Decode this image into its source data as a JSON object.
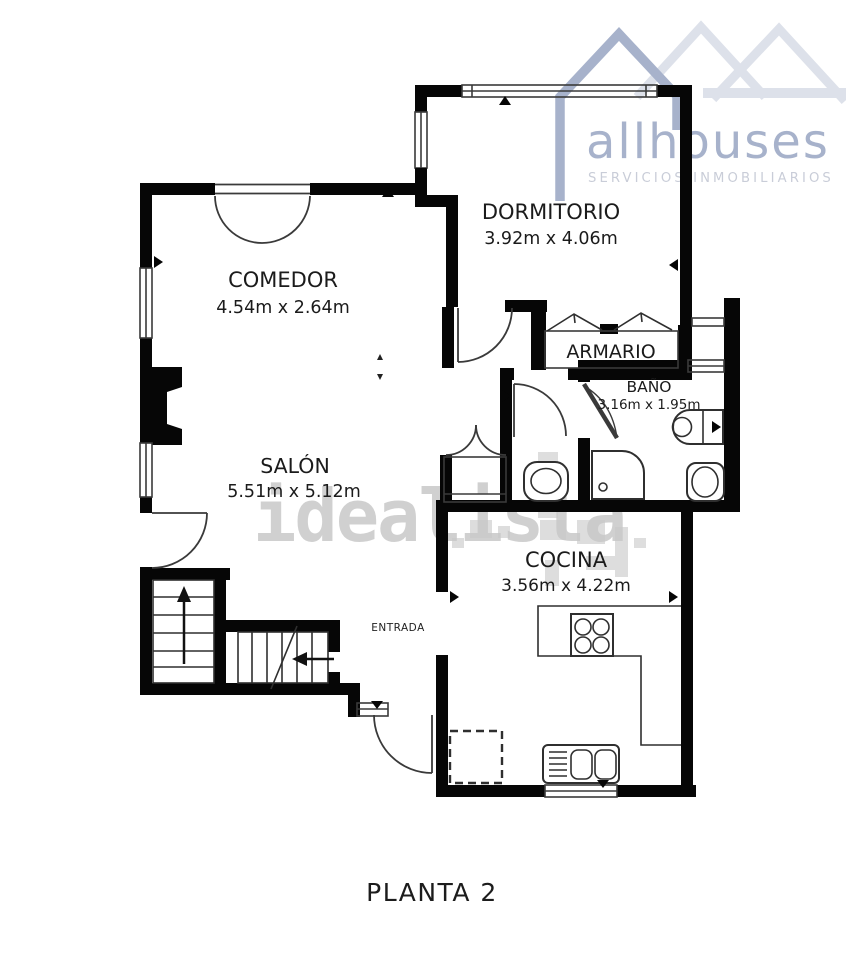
{
  "brand": {
    "name": "allhouses",
    "tagline": "SERVICIOS INMOBILIARIOS",
    "primary_color": "#a7b2cb",
    "light_color": "#dde1ea",
    "tagline_color": "#c9cdd8"
  },
  "watermark": {
    "text": "idealista",
    "color": "#c4c4c4"
  },
  "plan": {
    "wall_color": "#060606",
    "floor_label": "PLANTA 2",
    "rooms": {
      "comedor": {
        "name": "COMEDOR",
        "dims": "4.54m x 2.64m"
      },
      "dormitorio": {
        "name": "DORMITORIO",
        "dims": "3.92m x 4.06m"
      },
      "armario": {
        "name": "ARMARIO"
      },
      "bano": {
        "name": "BAÑO",
        "dims": "3.16m x 1.95m"
      },
      "salon": {
        "name": "SALÓN",
        "dims": "5.51m x 5.12m"
      },
      "cocina": {
        "name": "COCINA",
        "dims": "3.56m x 4.22m"
      },
      "entrada": {
        "name": "ENTRADA"
      }
    }
  }
}
